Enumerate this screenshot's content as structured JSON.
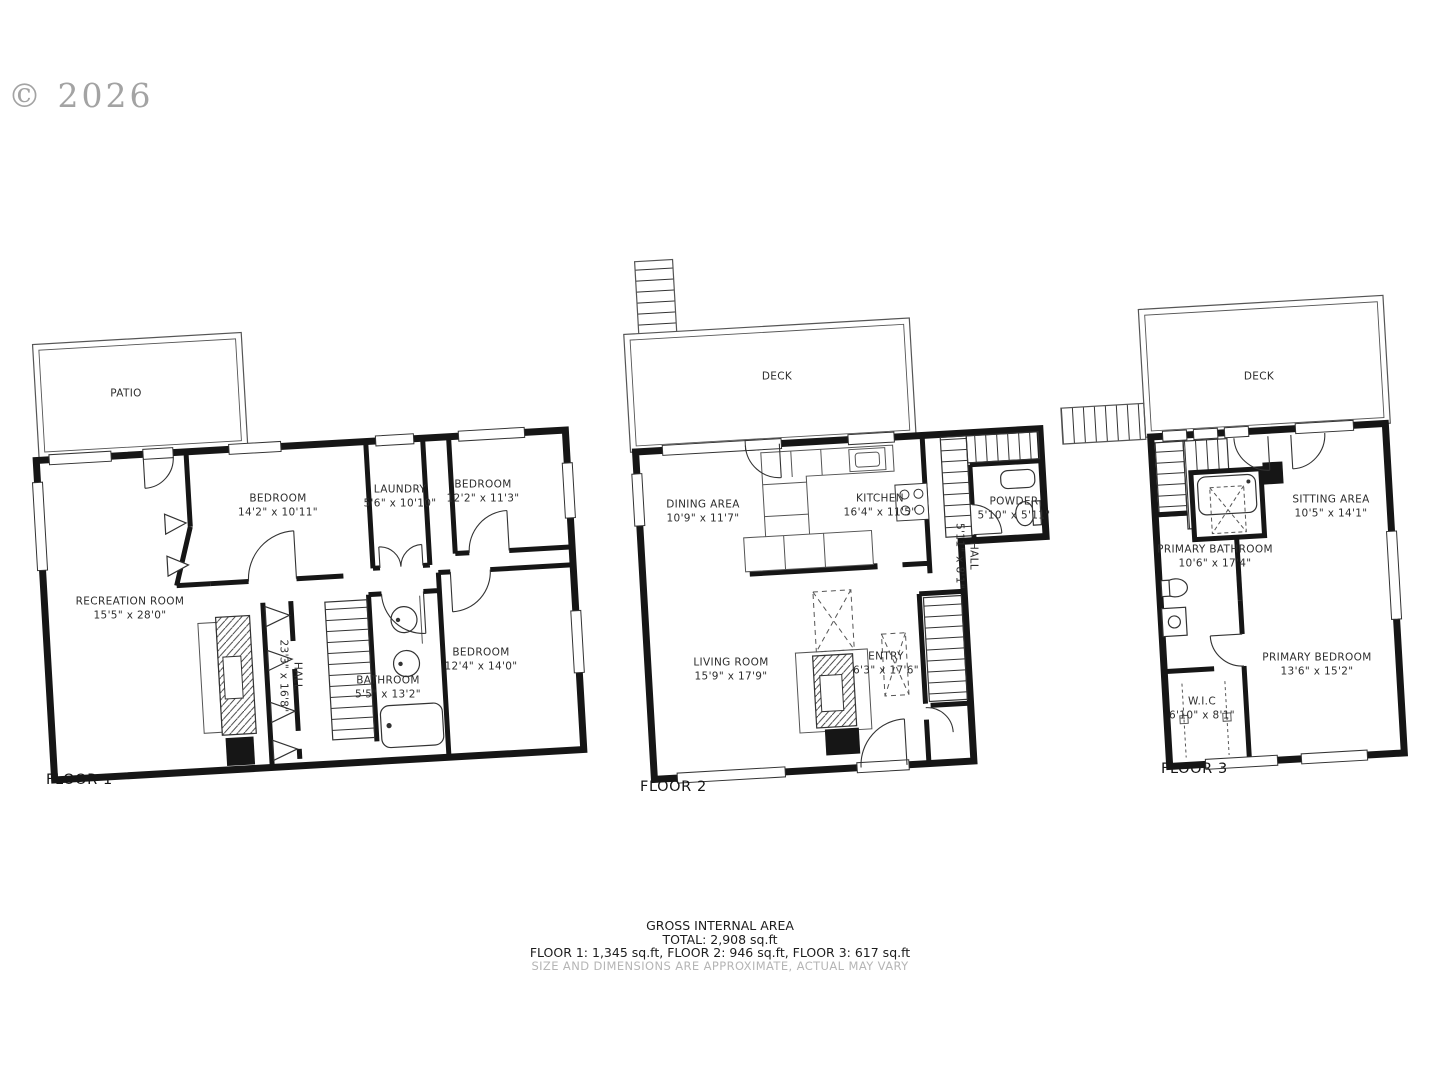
{
  "copyright": "© 2026",
  "floor1": {
    "name": "FLOOR 1",
    "patio": {
      "label": "PATIO"
    },
    "bedroom_top_left": {
      "label": "BEDROOM",
      "dims": "14'2\" x 10'11\""
    },
    "laundry": {
      "label": "LAUNDRY",
      "dims": "5'6\" x 10'10\""
    },
    "bedroom_top_right": {
      "label": "BEDROOM",
      "dims": "12'2\" x 11'3\""
    },
    "recreation": {
      "label": "RECREATION ROOM",
      "dims": "15'5\" x 28'0\""
    },
    "hall": {
      "label": "HALL",
      "dims": "23'3\" x 16'8\""
    },
    "bathroom": {
      "label": "BATHROOM",
      "dims": "5'5\" x 13'2\""
    },
    "bedroom_bottom": {
      "label": "BEDROOM",
      "dims": "12'4\" x 14'0\""
    }
  },
  "floor2": {
    "name": "FLOOR 2",
    "deck": {
      "label": "DECK"
    },
    "dining": {
      "label": "DINING AREA",
      "dims": "10'9\" x 11'7\""
    },
    "kitchen": {
      "label": "KITCHEN",
      "dims": "16'4\" x 11'5\""
    },
    "powder": {
      "label": "POWDER",
      "dims": "5'10\" x 5'11\""
    },
    "hall": {
      "label": "HALL",
      "dims": "5'11\" x 8'1\""
    },
    "living": {
      "label": "LIVING ROOM",
      "dims": "15'9\" x 17'9\""
    },
    "entry": {
      "label": "ENTRY",
      "dims": "6'3\" x 17'6\""
    }
  },
  "floor3": {
    "name": "FLOOR 3",
    "deck": {
      "label": "DECK"
    },
    "sitting": {
      "label": "SITTING AREA",
      "dims": "10'5\" x 14'1\""
    },
    "primary_bathroom": {
      "label": "PRIMARY BATHROOM",
      "dims": "10'6\" x 17'4\""
    },
    "primary_bedroom": {
      "label": "PRIMARY BEDROOM",
      "dims": "13'6\" x 15'2\""
    },
    "wic": {
      "label": "W.I.C",
      "dims": "6'10\" x 8'1\""
    }
  },
  "footer": {
    "title": "GROSS INTERNAL AREA",
    "total": "TOTAL: 2,908 sq.ft",
    "floors": "FLOOR 1: 1,345 sq.ft, FLOOR 2: 946 sq.ft, FLOOR 3: 617 sq.ft",
    "disclaimer": "SIZE AND DIMENSIONS ARE APPROXIMATE, ACTUAL MAY VARY"
  }
}
